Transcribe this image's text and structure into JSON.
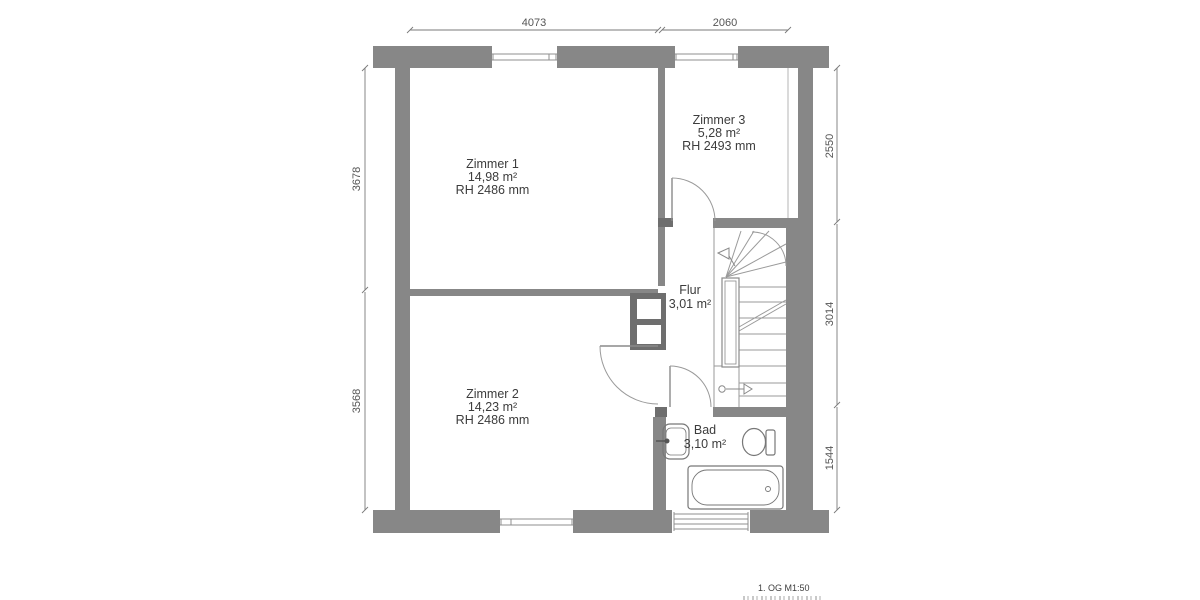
{
  "rooms": {
    "zimmer1": {
      "name": "Zimmer 1",
      "area": "14,98 m²",
      "height": "RH 2486 mm"
    },
    "zimmer2": {
      "name": "Zimmer 2",
      "area": "14,23 m²",
      "height": "RH 2486 mm"
    },
    "zimmer3": {
      "name": "Zimmer 3",
      "area": "5,28 m²",
      "height": "RH 2493 mm"
    },
    "flur": {
      "name": "Flur",
      "area": "3,01 m²"
    },
    "bad": {
      "name": "Bad",
      "area": "3,10 m²"
    }
  },
  "dimensions": {
    "top": [
      "4073",
      "2060"
    ],
    "left": [
      "3678",
      "3568"
    ],
    "right": [
      "2550",
      "3014",
      "1544"
    ]
  },
  "footer": {
    "scale_label": "1. OG M1:50"
  },
  "colors": {
    "wall": "#878787",
    "wall_dark": "#6e6e6e",
    "fixture_line": "#777777",
    "thin_line": "#9a9a9a",
    "label_text": "#3c3c3c",
    "dim_text": "#555555"
  }
}
